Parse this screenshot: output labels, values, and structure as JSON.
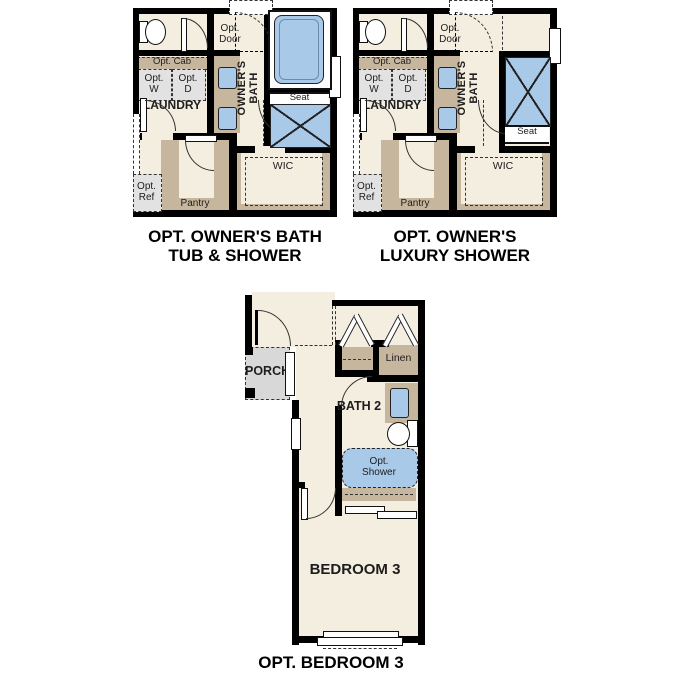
{
  "colors": {
    "background": "#ffffff",
    "wall": "#000000",
    "floor": "#f3eee0",
    "cabinetry_tan": "#c6b69d",
    "fixture_blue": "#a9c9e9",
    "optional_item_gray": "#e2e2e2",
    "porch_gray": "#d8d8d8",
    "line": "#222222"
  },
  "plans": [
    {
      "id": "opt-owners-bath-tub-and-shower",
      "caption": [
        "OPT. OWNER'S BATH",
        "TUB & SHOWER"
      ],
      "labels": {
        "opt_door": [
          "Opt.",
          "Door"
        ],
        "owners_bath": [
          "OWNER'S",
          "BATH"
        ],
        "opt_cab": "Opt. Cab",
        "opt_w": [
          "Opt.",
          "W"
        ],
        "opt_d": [
          "Opt.",
          "D"
        ],
        "laundry": "LAUNDRY",
        "seat": "Seat",
        "wic": "WIC",
        "pantry": "Pantry",
        "opt_ref": [
          "Opt.",
          "Ref"
        ]
      }
    },
    {
      "id": "opt-owners-luxury-shower",
      "caption": [
        "OPT. OWNER'S",
        "LUXURY SHOWER"
      ],
      "labels": {
        "opt_door": [
          "Opt.",
          "Door"
        ],
        "owners_bath": [
          "OWNER'S",
          "BATH"
        ],
        "opt_cab": "Opt. Cab",
        "opt_w": [
          "Opt.",
          "W"
        ],
        "opt_d": [
          "Opt.",
          "D"
        ],
        "laundry": "LAUNDRY",
        "seat": "Seat",
        "wic": "WIC",
        "pantry": "Pantry",
        "opt_ref": [
          "Opt.",
          "Ref"
        ]
      }
    },
    {
      "id": "opt-bedroom-3",
      "caption": [
        "OPT. BEDROOM 3"
      ],
      "labels": {
        "porch": "PORCH",
        "linen": "Linen",
        "bath_2": "BATH 2",
        "opt_shower": [
          "Opt.",
          "Shower"
        ],
        "bedroom_3": "BEDROOM 3"
      }
    }
  ]
}
